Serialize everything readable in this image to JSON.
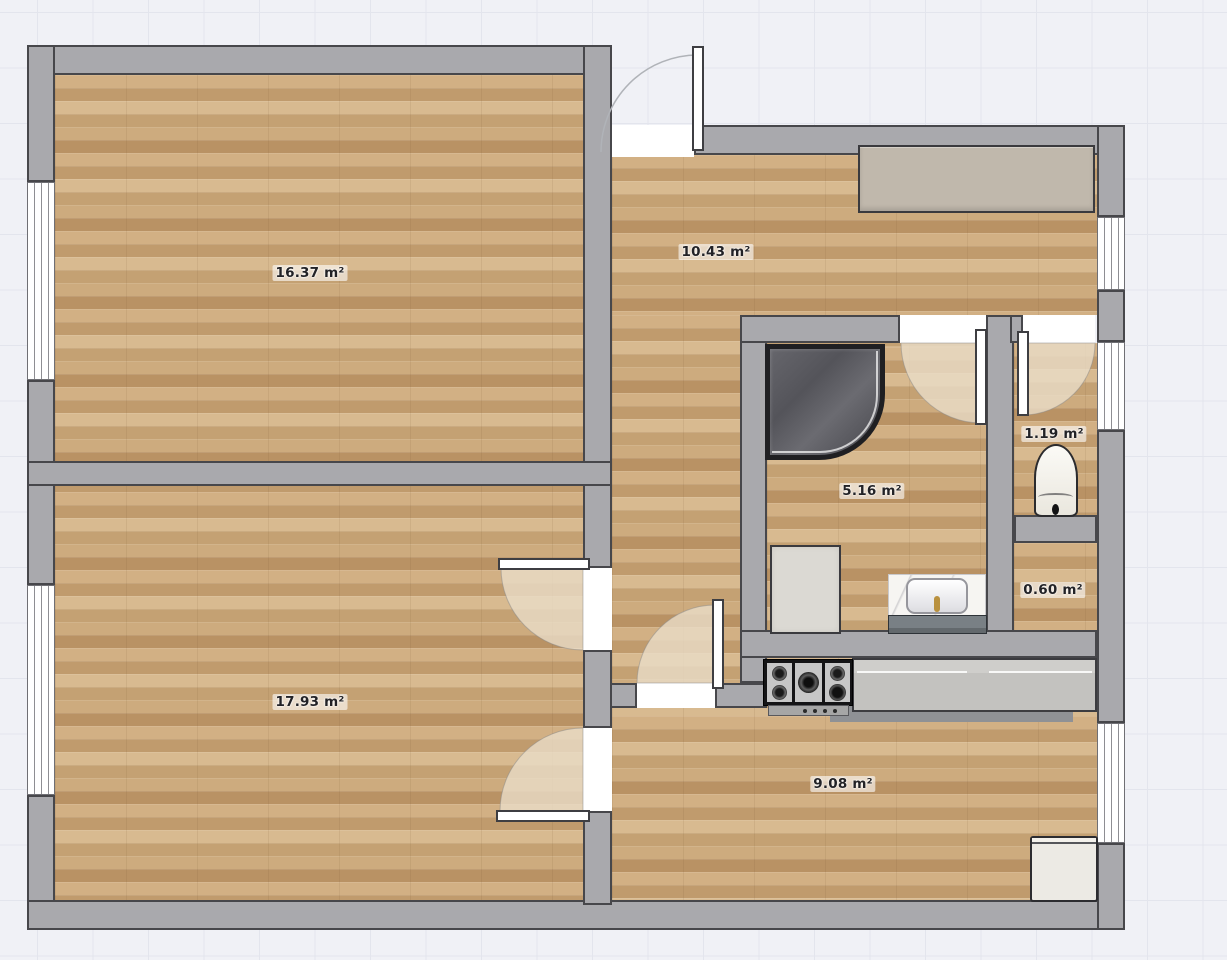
{
  "canvas": {
    "background": "#f0f1f6",
    "grid_line": "#e3e5ed"
  },
  "palette": {
    "wall": "#a9a9ad",
    "wall_outline": "#47474b",
    "floor_wood": "#c9a87a",
    "door_swing": "#e9dcc6",
    "shower_dark": "#5e5e63",
    "counter_gray": "#c8c7c4",
    "fixture_white": "#eceae4",
    "brass": "#b9913f"
  },
  "rooms": [
    {
      "name": "bedroom",
      "area_label": "16.37 m²"
    },
    {
      "name": "living-room",
      "area_label": "17.93 m²"
    },
    {
      "name": "hallway",
      "area_label": "10.43 m²"
    },
    {
      "name": "bathroom",
      "area_label": "5.16 m²"
    },
    {
      "name": "wc",
      "area_label": "1.19 m²"
    },
    {
      "name": "closet",
      "area_label": "0.60 m²"
    },
    {
      "name": "kitchen",
      "area_label": "9.08 m²"
    }
  ],
  "fixtures": [
    "wardrobe",
    "corner-shower",
    "washing-machine",
    "sink-vanity",
    "toilet",
    "gas-cooktop",
    "kitchen-counter",
    "refrigerator"
  ],
  "doors": [
    "entrance-door",
    "living-room-door-north",
    "living-room-door-south",
    "kitchen-door",
    "bathroom-door",
    "wc-door"
  ],
  "windows": [
    "bedroom-window",
    "living-room-window",
    "hallway-window",
    "wc-window",
    "kitchen-window"
  ]
}
